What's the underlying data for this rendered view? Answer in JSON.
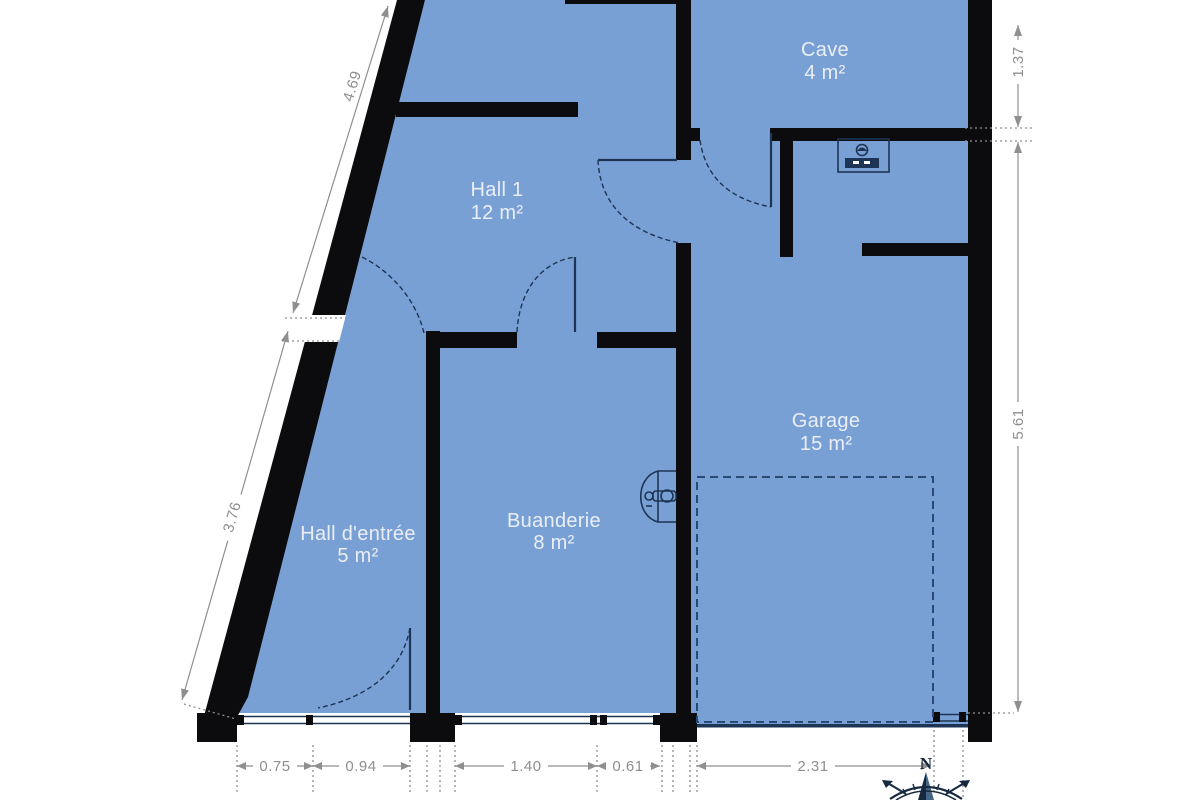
{
  "rooms": [
    {
      "name": "Cave",
      "area": "4 m²"
    },
    {
      "name": "Hall 1",
      "area": "12 m²"
    },
    {
      "name": "Garage",
      "area": "15 m²"
    },
    {
      "name": "Hall d'entrée",
      "area": "5 m²"
    },
    {
      "name": "Buanderie",
      "area": "8 m²"
    }
  ],
  "dimensions": {
    "bottom": [
      {
        "label": "0.75"
      },
      {
        "label": "0.94"
      },
      {
        "label": "1.40"
      },
      {
        "label": "0.61"
      },
      {
        "label": "2.31"
      }
    ],
    "left": [
      {
        "label": "4.69"
      },
      {
        "label": "3.76"
      }
    ],
    "right": [
      {
        "label": "1.37"
      },
      {
        "label": "5.61"
      }
    ]
  },
  "compass": {
    "north": "N"
  },
  "colors": {
    "floor": "#79a0d4",
    "wall": "#0c0c0e",
    "fixture": "#1d3454",
    "parking": "#2a4a74",
    "dim": "#8f8f8f",
    "label": "#eaeef5",
    "background": "#ffffff"
  }
}
